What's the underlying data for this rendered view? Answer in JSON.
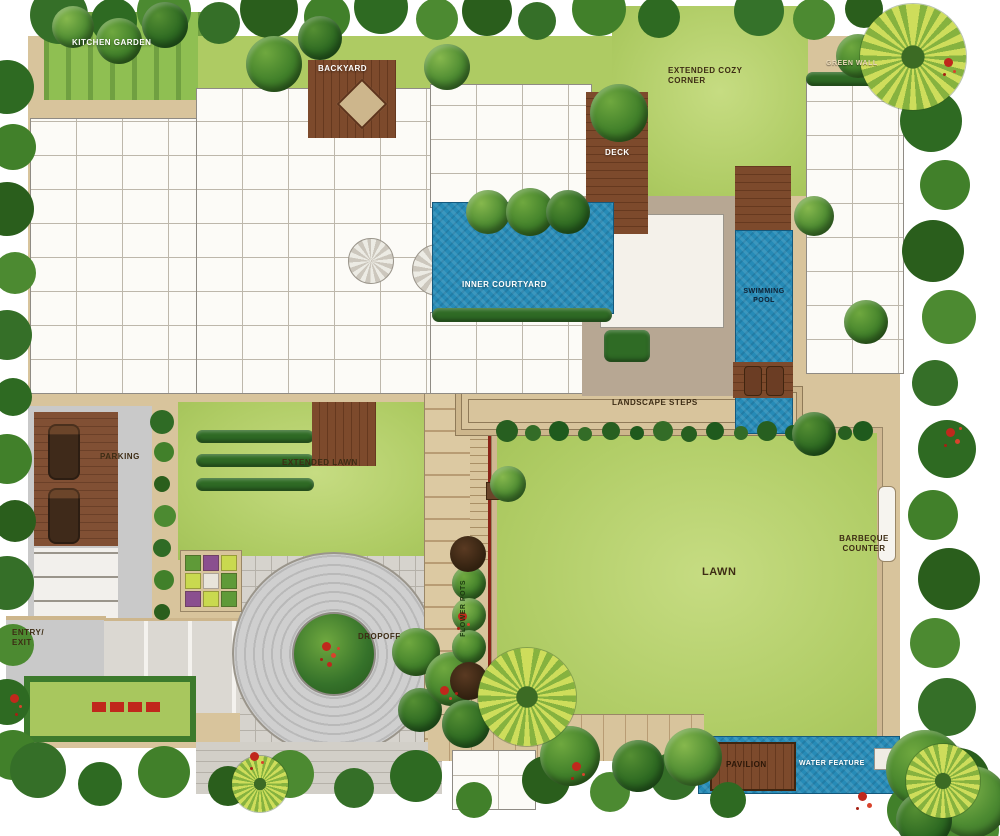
{
  "labels": {
    "kitchen_garden": "KITCHEN GARDEN",
    "backyard": "BACKYARD",
    "extended_cozy_corner": "EXTENDED COZY CORNER",
    "green_wall": "GREEN WALL",
    "deck": "DECK",
    "inner_courtyard": "INNER COURTYARD",
    "swimming_pool": "SWIMMING POOL",
    "landscape_steps": "LANDSCAPE STEPS",
    "parking": "PARKING",
    "extended_lawn": "EXTENDED LAWN",
    "lawn": "LAWN",
    "barbeque_counter": "BARBEQUE COUNTER",
    "entry_exit": "ENTRY/ EXIT",
    "dropoff": "DROPOFF",
    "flower_pots": "FLOWER POTS",
    "pavilion": "PAVILION",
    "water_feature": "WATER FEATURE"
  },
  "colors": {
    "lawn": "#b5d06c",
    "foliage_dark": "#2e6a22",
    "foliage_mid": "#4c8a31",
    "water": "#268bb7",
    "deck_wood": "#7d4a2c",
    "paving_tan": "#d8c49c",
    "road_gray": "#c9c9c9",
    "building_wall": "#8f8b84",
    "flower_red": "#c0281c",
    "label_dark": "#3d2c14"
  }
}
